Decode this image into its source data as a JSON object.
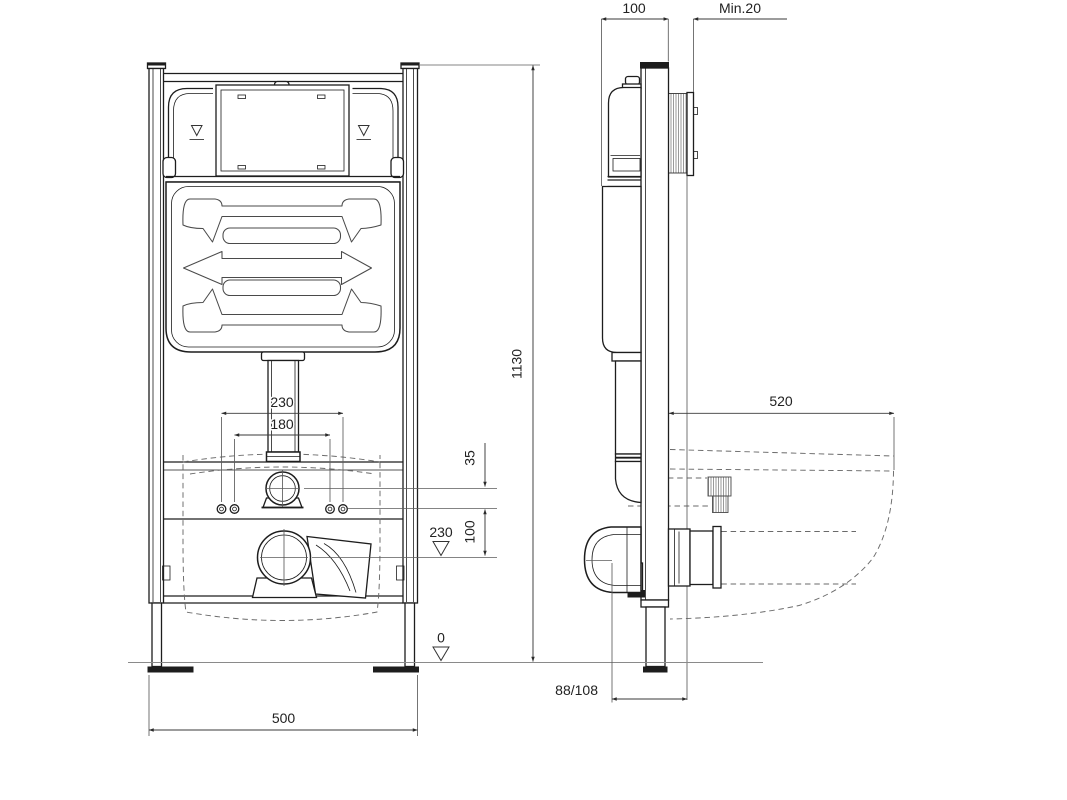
{
  "drawing": {
    "front_view": {
      "height": "1130",
      "width": "500",
      "holes_outer": "230",
      "holes_inner": "180",
      "supply_offset": "35",
      "supply_spacing": "100",
      "drain_level": "230",
      "floor_level": "0"
    },
    "side_view": {
      "depth": "100",
      "wall_min": "Min.20",
      "projection": "520",
      "outlet": "88/108"
    },
    "colors": {
      "line": "#1d1d1d",
      "dimension": "#3a3a3a",
      "background": "#ffffff"
    }
  }
}
